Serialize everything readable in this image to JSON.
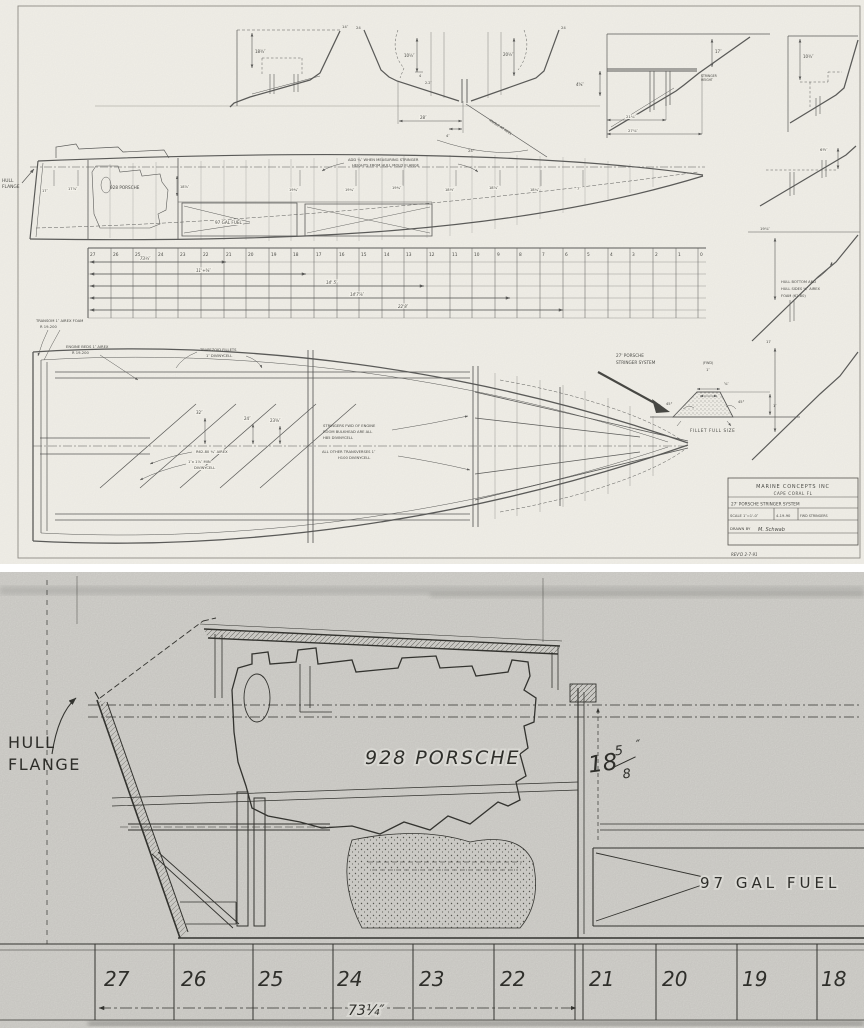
{
  "sheet1": {
    "sections": {
      "a_dim": "18¾″",
      "a_tip": "14″",
      "b_tip_left": "24",
      "b_tip_right": "24",
      "b_dim1": "10½″",
      "b_dim2": "4",
      "b_dim3": "2.2″",
      "b_dim4": "20½″",
      "b_width": "28″",
      "b_width2": "4″",
      "b_angle_label": "ANGLE AT KEEL",
      "b_angle": "24°",
      "c_dim1": "4⅝″",
      "c_dim2": "17″",
      "c_note1": "STRINGER",
      "c_note2": "HEIGHT",
      "c_dim3": "21¼″",
      "c_dim4": "27⅞″",
      "d_dim": "10¾″"
    },
    "right_strip": {
      "r1_dim": "6½″",
      "r2_dim": "19⅞″",
      "note1": "HULL BOTTOM AND",
      "note2": "HULL SIDES ¾″ AIREX",
      "note3": "FOAM (62-80)",
      "r3_dim": "17"
    },
    "profile": {
      "flange1": "HULL",
      "flange2": "FLANGE",
      "engine": "928 PORSCHE",
      "engine_dim": "18⅝″",
      "fuel": "97 GAL FUEL",
      "note1": "ADD ¾″ WHEN MEASURING STRINGER",
      "note2": "HEIGHTS FROM HULL MOLD FLANGE",
      "heights": [
        "17″",
        "17⅞″",
        "19¾″",
        "19¼″",
        "19¾″",
        "18½″",
        "18⅝″",
        "18¼″",
        "7″"
      ],
      "dims": [
        "73¼″",
        "11'+⅝″",
        "14' 5″",
        "14'7⅞″",
        "22'8″"
      ],
      "stations": [
        "27",
        "26",
        "25",
        "24",
        "23",
        "22",
        "21",
        "20",
        "19",
        "18",
        "17",
        "16",
        "15",
        "14",
        "13",
        "12",
        "11",
        "10",
        "9",
        "8",
        "7",
        "6",
        "5",
        "4",
        "3",
        "2",
        "1",
        "0"
      ]
    },
    "plan": {
      "transom_note1": "TRANSOM 1″ AIREX FOAM",
      "transom_note2": "R 19-200",
      "beds_note1": "ENGINE BEDS 1″ AIREX",
      "beds_note2": "R 19-200",
      "fillets_note1": "TRAPEZOID FILLETS",
      "fillets_note2": "1″ DIVINYCELL",
      "stringers_note1": "STRINGERS FWD OF ENGINE",
      "stringers_note2": "ROOM BULKHEAD ARE ALL",
      "stringers_note3": "H85 DIVINYCELL",
      "transverses_note1": "ALL OTHER TRANSVERSES 1″",
      "transverses_note2": "H100 DIVINYCELL",
      "airex_note": "R62-80 ¾″ AIREX",
      "div_note1": "1″x 1⅞″ MIN",
      "div_note2": "DIVINYCELL",
      "dim1": "32″",
      "dim2": "24″",
      "dim3": "23⅝″"
    },
    "callout": {
      "line1": "27' PORSCHE",
      "line2": "STRINGER SYSTEM"
    },
    "fillet": {
      "fwd": "(FWD)",
      "top": "1″",
      "mid": "⅝″",
      "left_angle": "45°",
      "right_angle": "45°",
      "height": "1″",
      "caption": "FILLET FULL SIZE"
    },
    "title_block": {
      "company": "MARINE CONCEPTS INC",
      "city": "CAPE CORAL FL",
      "title": "27' PORSCHE STRINGER SYSTEM",
      "scale": "SCALE 1″=1'-0″",
      "date": "4-19-90",
      "ref": "FWD STRINGERS",
      "drawn_label": "DRAWN BY",
      "drawn_by": "M. Schwab",
      "rev": "REV'D 2-7-91"
    }
  },
  "sheet2": {
    "flange1": "HULL",
    "flange2": "FLANGE",
    "engine": "928 PORSCHE",
    "height_dim": {
      "whole": "18",
      "num": "5",
      "den": "8",
      "unit": "″"
    },
    "fuel": "97 GAL FUEL",
    "stations": [
      "27",
      "26",
      "25",
      "24",
      "23",
      "22",
      "21",
      "20",
      "19",
      "18"
    ],
    "width_dim": "73¼″"
  }
}
